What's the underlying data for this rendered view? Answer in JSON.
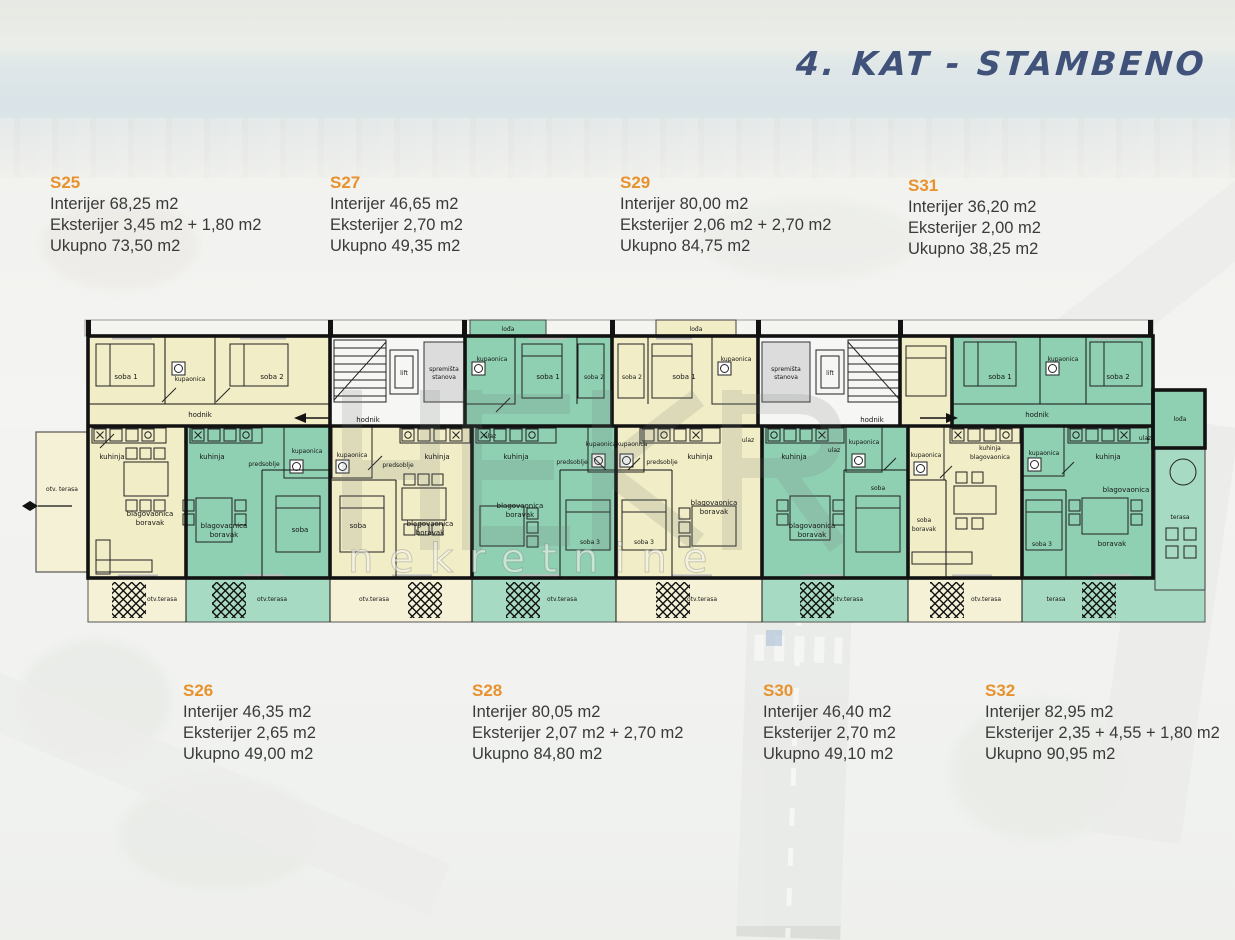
{
  "title": "4. KAT - STAMBENO",
  "watermark": "nekretnine",
  "units": {
    "s25": {
      "code": "S25",
      "interior": "Interijer 68,25 m2",
      "exterior": "Eksterijer 3,45 m2 + 1,80 m2",
      "total": "Ukupno 73,50 m2"
    },
    "s27": {
      "code": "S27",
      "interior": "Interijer 46,65 m2",
      "exterior": "Eksterijer 2,70 m2",
      "total": "Ukupno 49,35 m2"
    },
    "s29": {
      "code": "S29",
      "interior": "Interijer 80,00 m2",
      "exterior": "Eksterijer 2,06 m2 + 2,70 m2",
      "total": "Ukupno 84,75 m2"
    },
    "s31": {
      "code": "S31",
      "interior": "Interijer 36,20 m2",
      "exterior": "Eksterijer 2,00 m2",
      "total": "Ukupno 38,25 m2"
    },
    "s26": {
      "code": "S26",
      "interior": "Interijer 46,35 m2",
      "exterior": "Eksterijer 2,65 m2",
      "total": "Ukupno 49,00 m2"
    },
    "s28": {
      "code": "S28",
      "interior": "Interijer 80,05 m2",
      "exterior": "Eksterijer 2,07 m2 + 2,70 m2",
      "total": "Ukupno 84,80 m2"
    },
    "s30": {
      "code": "S30",
      "interior": "Interijer 46,40 m2",
      "exterior": "Eksterijer 2,70 m2",
      "total": "Ukupno 49,10 m2"
    },
    "s32": {
      "code": "S32",
      "interior": "Interijer 82,95 m2",
      "exterior": "Eksterijer 2,35 + 4,55 + 1,80 m2",
      "total": "Ukupno 90,95 m2"
    }
  },
  "plan": {
    "room_labels": {
      "soba": "soba",
      "soba1": "soba 1",
      "soba2": "soba 2",
      "soba3": "soba 3",
      "kuhinja": "kuhinja",
      "kupaonica": "kupaonica",
      "predsoblje": "predsoblje",
      "blagovaonica": "blagovaonica",
      "boravak": "boravak",
      "hodnik": "hodnik",
      "ulaz": "ulaz",
      "lift": "lift",
      "spremista": "spremišta",
      "stanova": "stanova",
      "otv_terasa": "otv.terasa",
      "otv_terasa_sp": "otv. terasa",
      "terasa": "terasa",
      "loda": "lođa"
    },
    "colors": {
      "cream": "#f1edc6",
      "cream_terrace": "#f5f1d6",
      "green": "#8fd0b2",
      "green_terrace": "#a6dac2",
      "wall": "#121212",
      "core_gray": "#dcdcdc",
      "accent_orange": "#e8922d",
      "title_blue": "#40527a"
    }
  }
}
